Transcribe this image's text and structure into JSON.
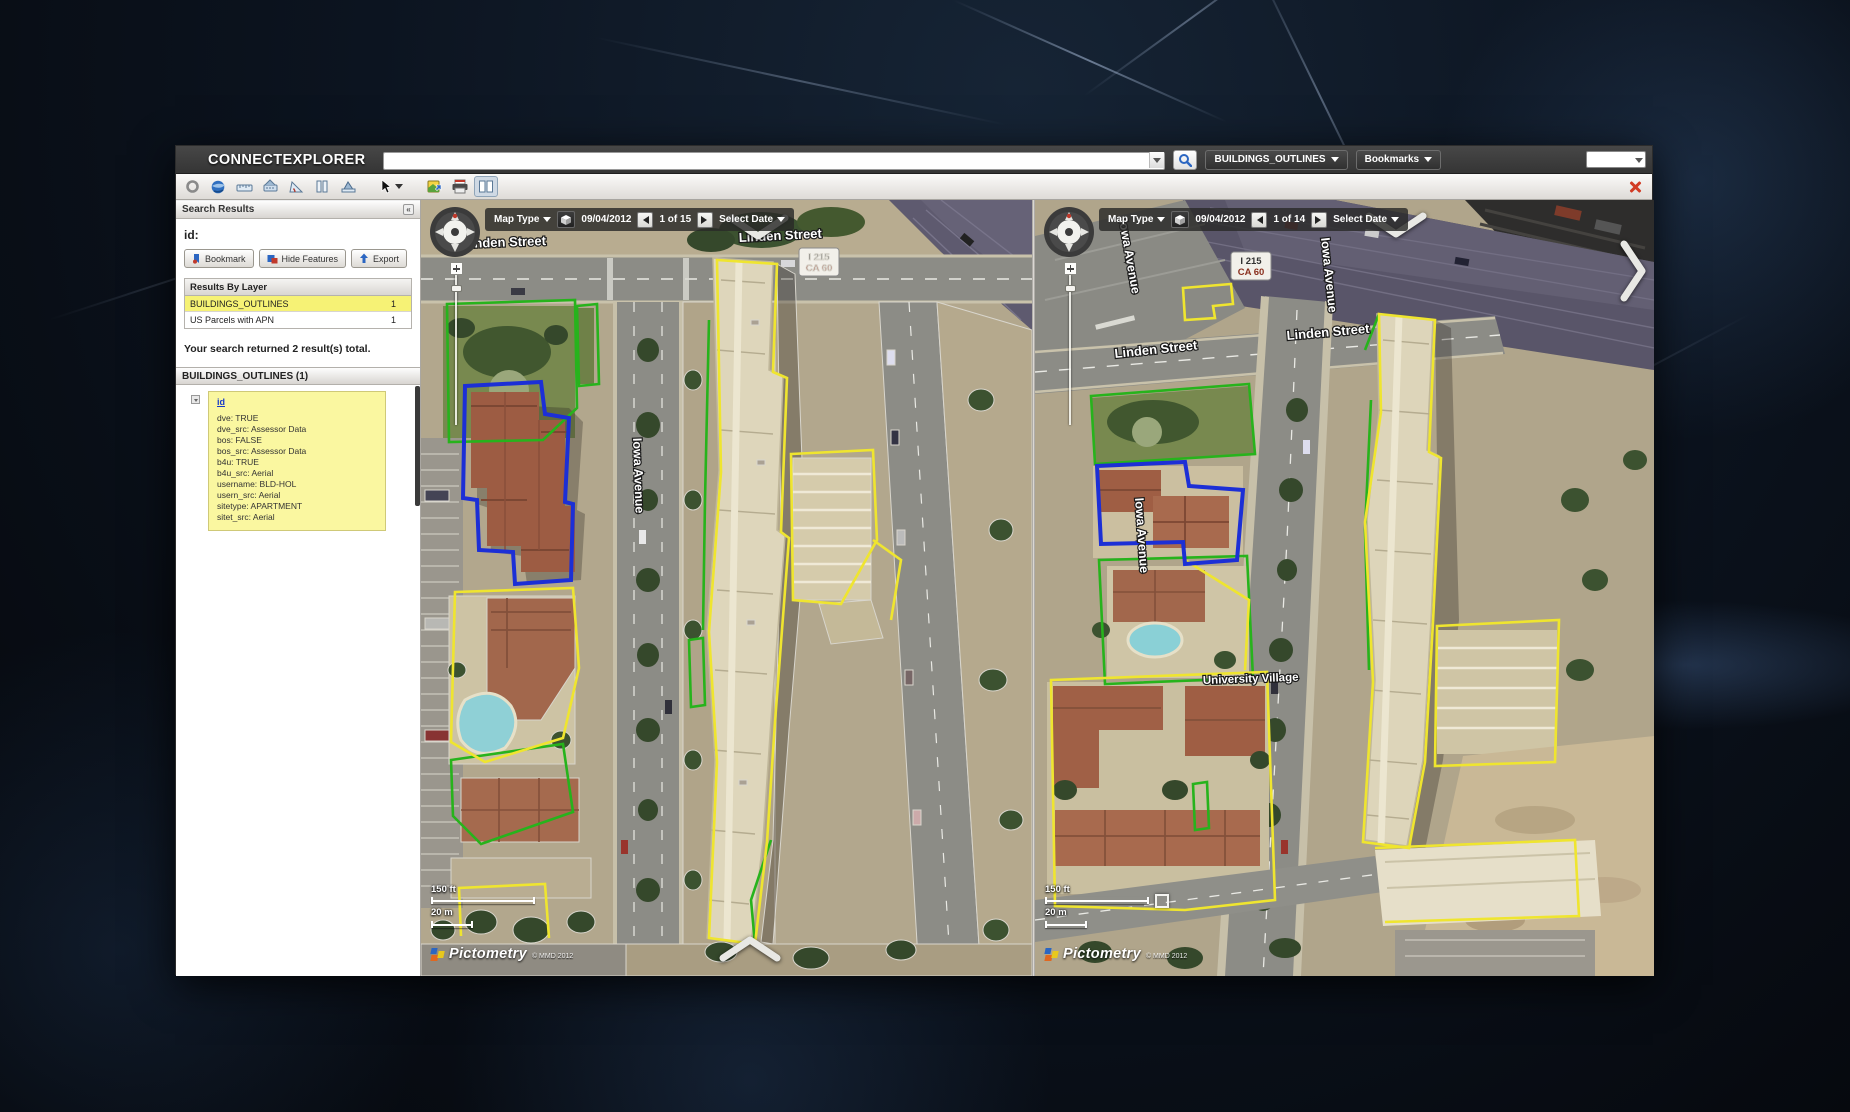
{
  "topbar": {
    "logo": "CONNECTEXPLORER",
    "search_value": "",
    "layer_button": "BUILDINGS_OUTLINES",
    "bookmarks_button": "Bookmarks"
  },
  "toolbar": {
    "icons": [
      "refresh-icon",
      "globe-icon",
      "measure-distance-icon",
      "measure-height-icon",
      "measure-angle-icon",
      "compare-columns-icon",
      "measure-area-icon",
      "select-tool-icon",
      "export-image-icon",
      "print-icon",
      "split-view-icon",
      "close-icon"
    ]
  },
  "sidebar": {
    "header": "Search Results",
    "id_label": "id:",
    "buttons": {
      "bookmark": "Bookmark",
      "hide_features": "Hide Features",
      "export": "Export"
    },
    "results_by_layer": {
      "title": "Results By Layer",
      "rows": [
        {
          "layer": "BUILDINGS_OUTLINES",
          "count": "1"
        },
        {
          "layer": "US Parcels with APN",
          "count": "1"
        }
      ]
    },
    "summary": "Your search returned 2 result(s) total.",
    "section_title": "BUILDINGS_OUTLINES (1)",
    "feature": {
      "link": "id",
      "attributes": [
        "dve: TRUE",
        "dve_src: Assessor Data",
        "bos: FALSE",
        "bos_src: Assessor Data",
        "b4u: TRUE",
        "b4u_src: Aerial",
        "username: BLD-HOL",
        "usern_src: Aerial",
        "sitetype: APARTMENT",
        "sitet_src: Aerial"
      ]
    }
  },
  "panes": [
    {
      "map_type_label": "Map Type",
      "date": "09/04/2012",
      "position": "1 of 15",
      "select_date_label": "Select Date",
      "labels": {
        "street_a": "Linden Street",
        "street_b": "Linden Street",
        "avenue": "Iowa Avenue",
        "shield_line1": "I 215",
        "shield_line2": "CA 60"
      },
      "scale_ft": "150 ft",
      "scale_m": "20 m",
      "logo": "Pictometry",
      "copyright": "© MMD 2012"
    },
    {
      "map_type_label": "Map Type",
      "date": "09/04/2012",
      "position": "1 of 14",
      "select_date_label": "Select Date",
      "labels": {
        "street_a": "Linden Street",
        "street_b": "Linden Street",
        "avenue_top": "Iowa Avenue",
        "avenue_mid": "Iowa Avenue",
        "avenue_right": "Iowa Avenue",
        "shield_line1": "I 215",
        "shield_line2": "CA 60",
        "area": "University Village"
      },
      "scale_ft": "150 ft",
      "scale_m": "20 m",
      "logo": "Pictometry",
      "copyright": "© MMD 2012"
    }
  ]
}
